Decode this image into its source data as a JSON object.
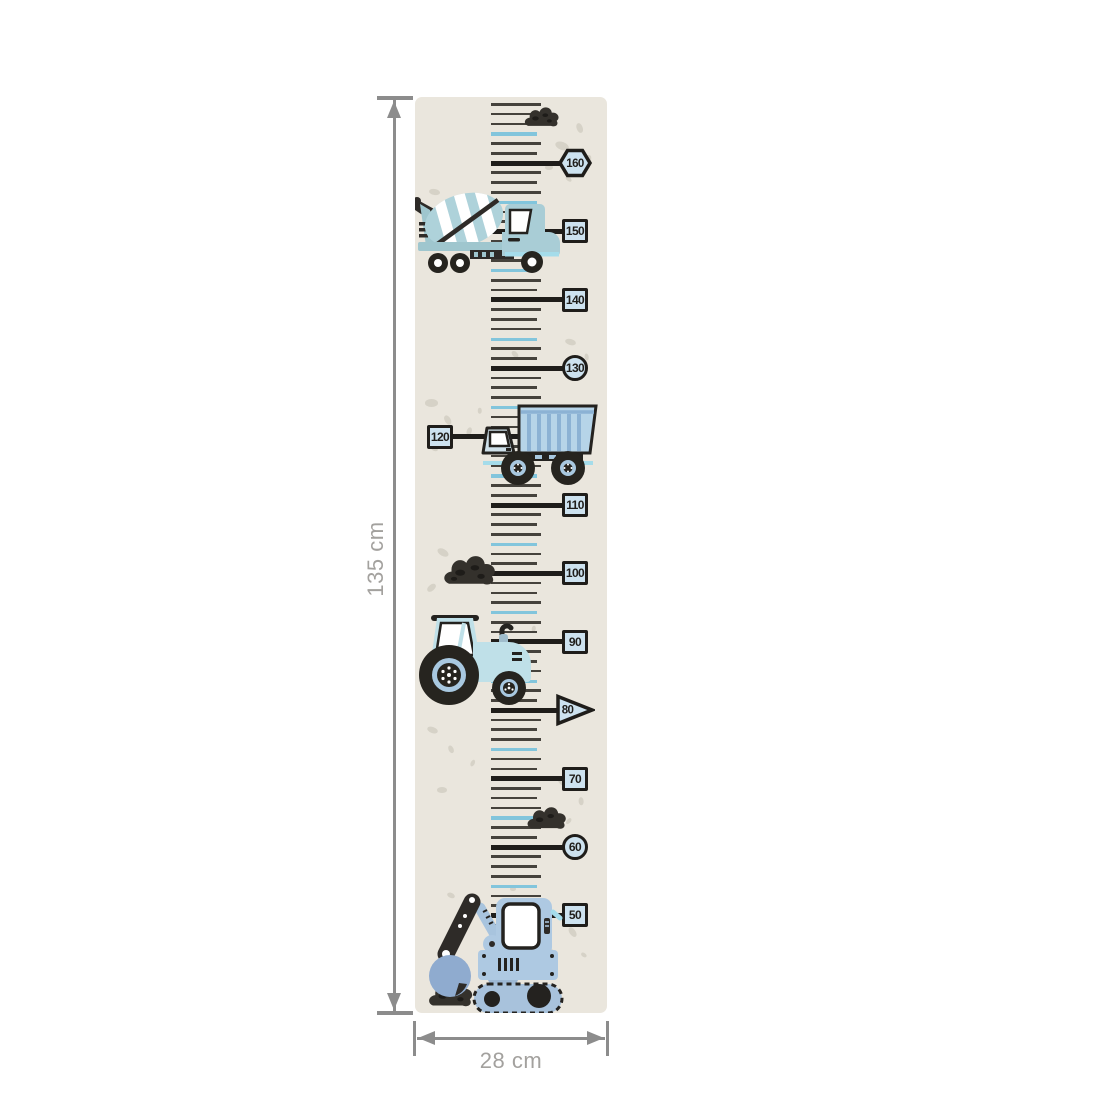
{
  "product": {
    "type": "kids-growth-chart-wall-sticker",
    "theme": "construction-vehicles"
  },
  "dimensions": {
    "height_label": "135 cm",
    "width_label": "28 cm"
  },
  "chart": {
    "unit": "cm",
    "range": {
      "min": 50,
      "max": 160,
      "step": 10
    },
    "labels": [
      {
        "value": "160",
        "shape": "hexagon",
        "side": "right"
      },
      {
        "value": "150",
        "shape": "square",
        "side": "right"
      },
      {
        "value": "140",
        "shape": "square",
        "side": "right"
      },
      {
        "value": "130",
        "shape": "circle",
        "side": "right"
      },
      {
        "value": "120",
        "shape": "square",
        "side": "left"
      },
      {
        "value": "110",
        "shape": "square",
        "side": "right"
      },
      {
        "value": "100",
        "shape": "square",
        "side": "right"
      },
      {
        "value": "90",
        "shape": "square",
        "side": "right"
      },
      {
        "value": "80",
        "shape": "triangle",
        "side": "right"
      },
      {
        "value": "70",
        "shape": "square",
        "side": "right"
      },
      {
        "value": "60",
        "shape": "circle",
        "side": "right"
      },
      {
        "value": "50",
        "shape": "square",
        "side": "right"
      }
    ]
  },
  "illustrations": {
    "vehicles": [
      "cement-mixer-truck-icon",
      "dump-truck-icon",
      "tractor-icon",
      "excavator-icon"
    ],
    "decorations": [
      "dirt-pile-icon",
      "background-speckles"
    ]
  },
  "colors": {
    "line": "#1f1d1a",
    "badge_fill": "#cde2ef",
    "tick": "#45423c",
    "tick_blue": "#82c5dc",
    "strip_bg": "#eae6dd",
    "speckle": "#d6d2c7",
    "dimension_line": "#8c8c8c",
    "dimension_text": "#a3a19e",
    "vehicle_teal": "#a9cdd6",
    "vehicle_blue": "#b6d4e8",
    "vehicle_powder": "#bfe0e8",
    "vehicle_periwinkle": "#aec9e2",
    "accent_cyan": "#a5dcea",
    "dark": "#2b2926"
  }
}
